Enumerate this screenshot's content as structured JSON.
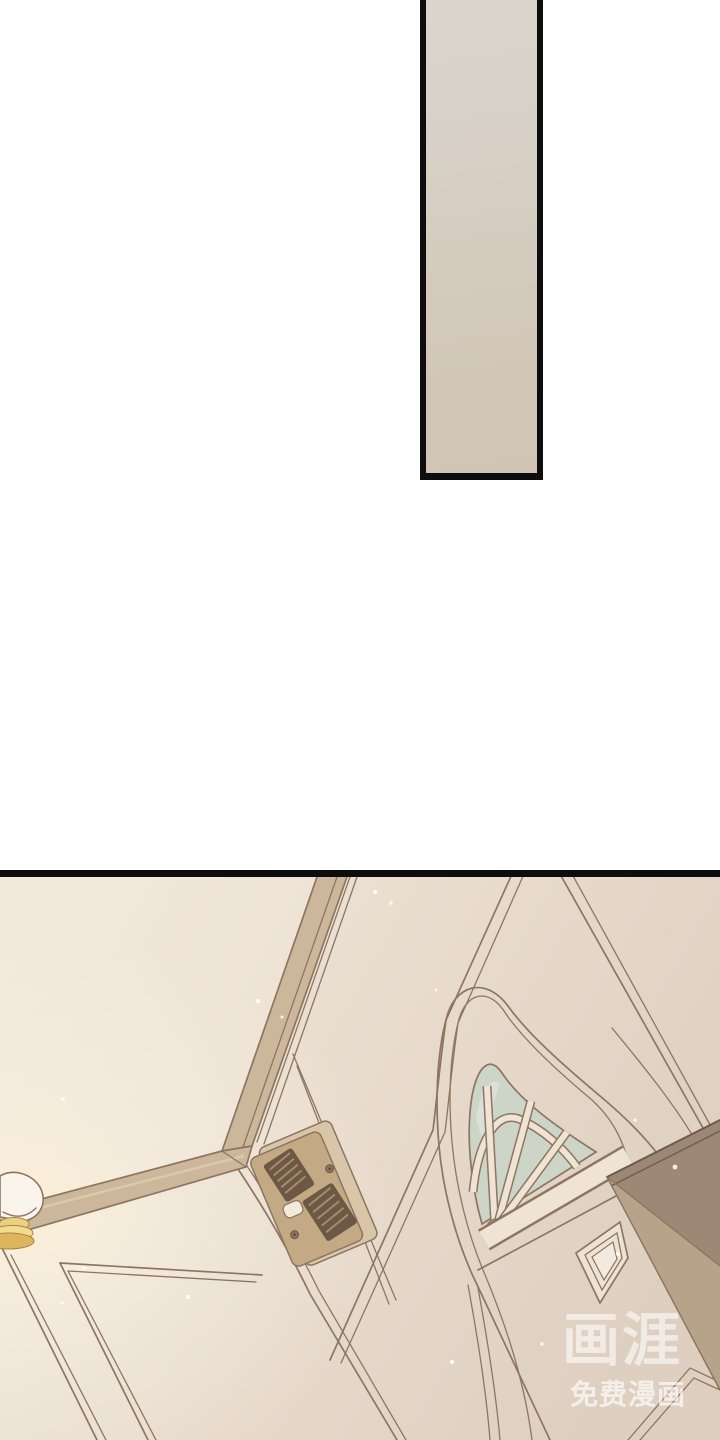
{
  "page": {
    "width": 720,
    "height": 1440,
    "background_color": "#ffffff",
    "content_type": "webtoon comic page, vertical scroll"
  },
  "panels": {
    "top_panel": {
      "description": "tall narrow blank panel showing a sliver of beige wall",
      "border_color": "#0d0d0d",
      "fill_top": "#dad4cb",
      "fill_bottom": "#d0c5b2"
    },
    "main_panel": {
      "description": "low-angle tilted view of an apartment entryway: cream panelled walls with chair rail and corner trim, small wall lamp at left, doorbell intercom on the wall, front door with arched fanlight window and diamond moulding panel, dark cabinet corner at right",
      "border_color": "#0d0d0d"
    }
  },
  "scene": {
    "colors": {
      "wall_light": "#f1e8db",
      "wall_dark": "#decfc0",
      "outline": "#8d7562",
      "trim_fill": "#cdb79b",
      "trim_highlight": "#dcc9ad",
      "glass": "#ccd5c8",
      "muntin": "#efe4d3",
      "door_panel": "#ece3d5",
      "intercom_plate": "#d9c6a8",
      "intercom_body": "#c3aa84",
      "intercom_grille": "#6d5845",
      "intercom_button": "#f2ebdb",
      "cabinet_top": "#9c8874",
      "cabinet_front": "#b7a28a",
      "lamp_shade": "#faf5ec",
      "lamp_gold": "#f2dc92",
      "sparkle": "#ffffff"
    },
    "objects": {
      "corner_trim": "wall corner moulding",
      "chair_rail": "chair rail on left wall",
      "wainscot": "wainscot panel outlines",
      "wall_lamp": "lamp with white shade and gold base",
      "intercom": "door phone intercom with two speaker grilles and call button",
      "fanlight": "arched door window with radiating muntins",
      "diamond_panel": "diamond moulding panel on door",
      "cabinet": "dark cabinet corner entering from right edge"
    }
  },
  "watermark": {
    "logo_text": "画涯",
    "subtitle": "免费漫画",
    "color": "#ffffff"
  }
}
